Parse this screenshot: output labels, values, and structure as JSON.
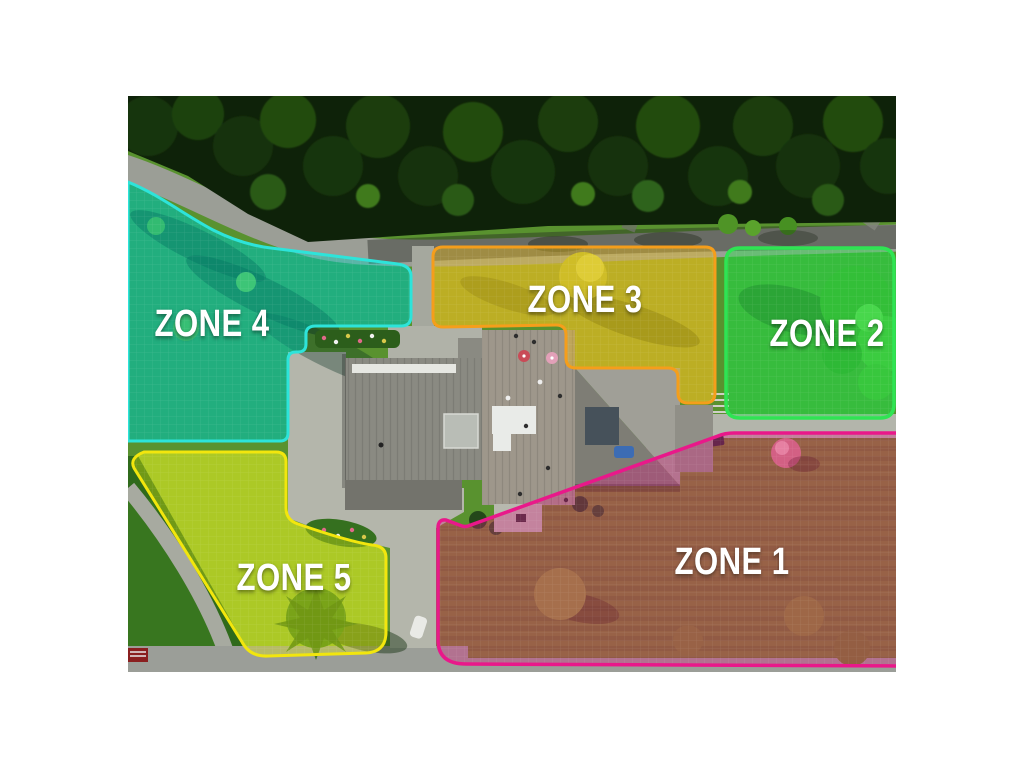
{
  "page": {
    "background_color": "#ffffff"
  },
  "map": {
    "zones": [
      {
        "label": "ZONE 1",
        "border_color": "#e9188a",
        "fill_color": "rgba(226,24,128,0.33)",
        "base_color": "#75862c"
      },
      {
        "label": "ZONE 2",
        "border_color": "#2fe453",
        "fill_color": "rgba(46,224,80,0.45)",
        "base_color": "#3f9e2e"
      },
      {
        "label": "ZONE 3",
        "border_color": "#f59e1b",
        "fill_color": "rgba(240,190,20,0.40)",
        "base_color": "#9aa32f"
      },
      {
        "label": "ZONE 4",
        "border_color": "#2de4da",
        "fill_color": "rgba(0,214,190,0.42)",
        "base_color": "#3c9150"
      },
      {
        "label": "ZONE 5",
        "border_color": "#f2e60d",
        "fill_color": "rgba(235,240,15,0.35)",
        "base_color": "#8ab433"
      }
    ]
  }
}
